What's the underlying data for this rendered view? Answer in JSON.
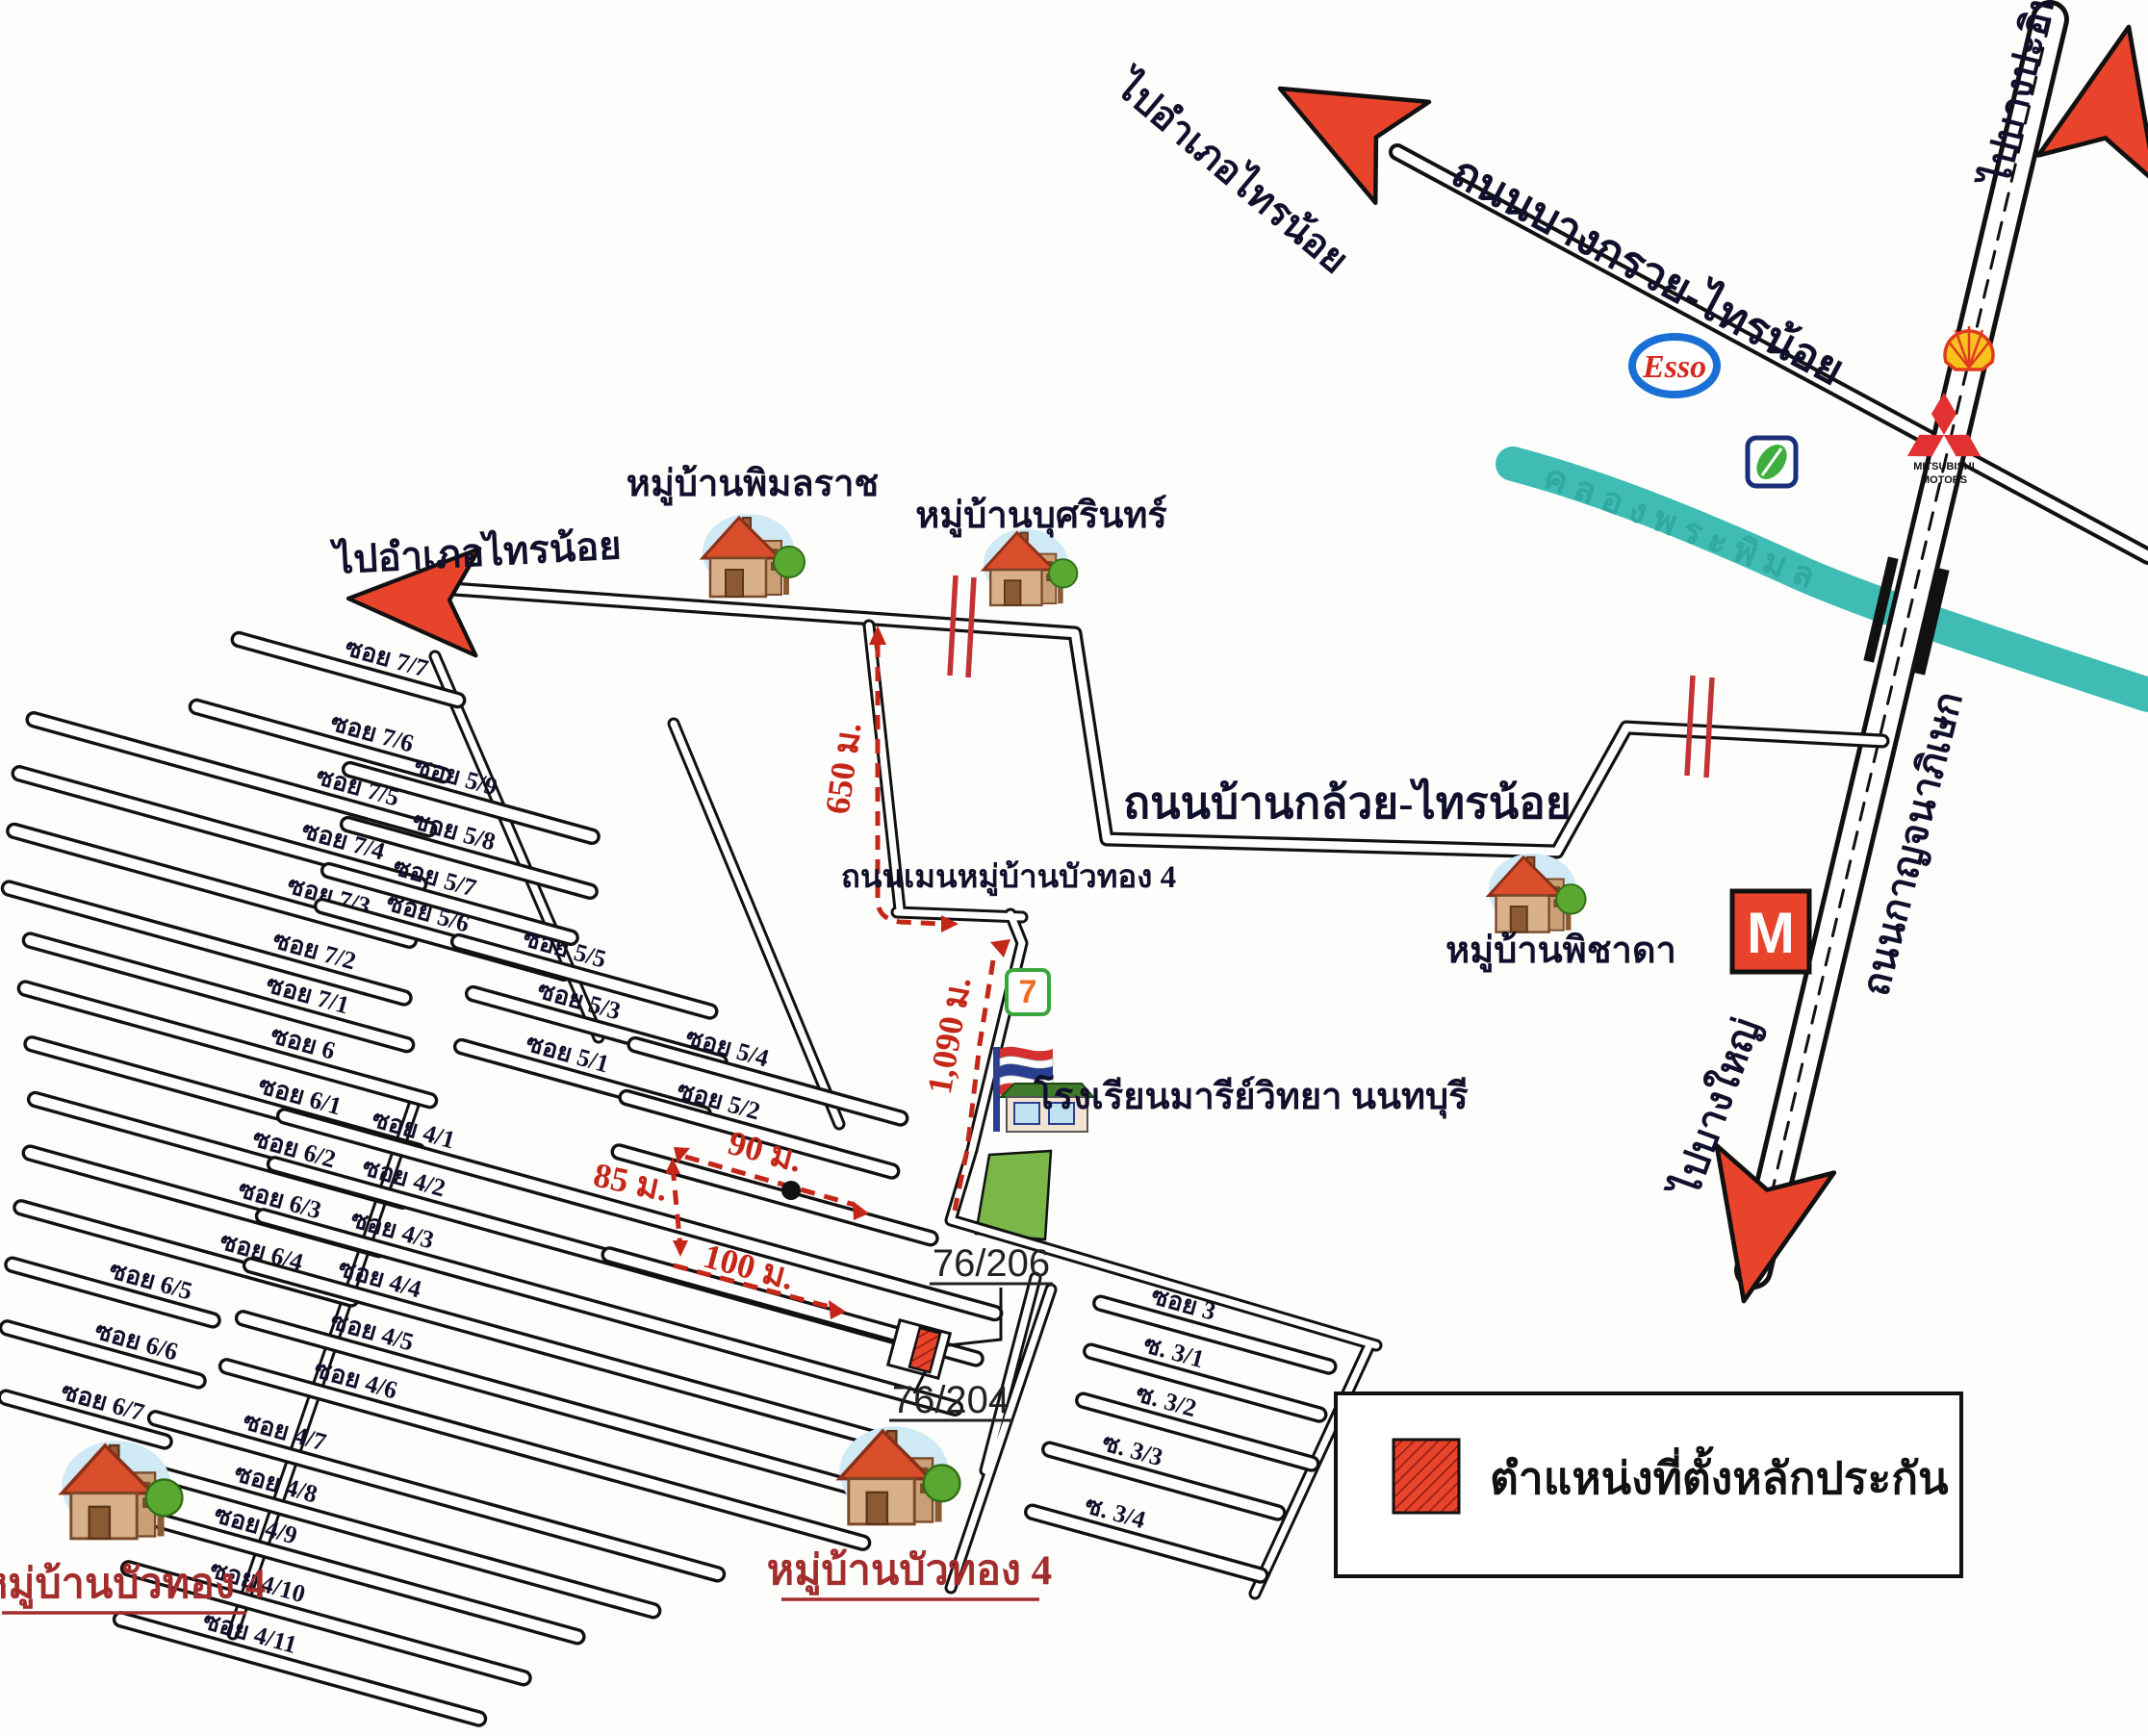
{
  "map": {
    "directions": {
      "to_sainoi_diag": "ไปอำเภอไทรน้อย",
      "to_bangpain": "ไปบางปะอิน",
      "to_sainoi_left": "ไปอำเภอไทรน้อย",
      "to_bangyai": "ไปบางใหญ่"
    },
    "roads": {
      "bangkruai_sainoi": "ถนนบางกรวย-ไทรน้อย",
      "kanchanaphisek": "ถนนกาญจนาภิเษก",
      "bankluai_sainoi": "ถนนบ้านกล้วย-ไทรน้อย",
      "main_buathong": "ถนนเมนหมู่บ้านบัวทอง 4"
    },
    "canal": "คลองพระพิมล",
    "places": {
      "pimonrat": "หมู่บ้านพิมลราช",
      "busarin": "หมู่บ้านบุศรินทร์",
      "phichada": "หมู่บ้านพิชาดา",
      "school": "โรงเรียนมารีย์วิทยา นนทบุรี",
      "buathong_left": "หมู่บ้านบัวทอง 4",
      "buathong_center": "หมู่บ้านบัวทอง 4"
    },
    "distances": {
      "d650": "650 ม.",
      "d1090": "1,090 ม.",
      "d90": "90 ม.",
      "d85": "85 ม.",
      "d100": "100 ม."
    },
    "house_numbers": {
      "upper": "76/206",
      "lower": "76/204"
    },
    "sois": {
      "colA": [
        "ซอย 7/7",
        "ซอย 7/6",
        "ซอย 7/5",
        "ซอย 7/4",
        "ซอย 7/3",
        "ซอย 7/2",
        "ซอย 7/1",
        "ซอย 6",
        "ซอย 6/1",
        "ซอย 6/2",
        "ซอย 6/3",
        "ซอย 6/4",
        "ซอย 6/5",
        "ซอย 6/6",
        "ซอย 6/7"
      ],
      "colB": [
        "ซอย 5/9",
        "ซอย 5/8",
        "ซอย 5/7",
        "ซอย 5/6",
        "ซอย 5/5",
        "ซอย 5/3",
        "ซอย 5/1",
        "ซอย 5/4",
        "ซอย 5/2"
      ],
      "colC": [
        "ซอย 4/1",
        "ซอย 4/2",
        "ซอย 4/3",
        "ซอย 4/4",
        "ซอย 4/5",
        "ซอย 4/6",
        "ซอย 4/7",
        "ซอย 4/8",
        "ซอย 4/9",
        "ซอย 4/10",
        "ซอย 4/11"
      ],
      "colD": [
        "ซอย 3",
        "ซ. 3/1",
        "ซ. 3/2",
        "ซ. 3/3",
        "ซ. 3/4"
      ]
    },
    "legend": {
      "label": "ตำแหน่งที่ตั้งหลักประกัน"
    },
    "logos": {
      "esso": "Esso",
      "seven": "7",
      "mitsubishi": "MITSUBISHI",
      "motors": "MOTORS",
      "makro_m": "M"
    },
    "colors": {
      "accent_red": "#e8432b",
      "route_red": "#c42618",
      "canal_teal": "#3fbdb5",
      "field_green": "#7ab648",
      "text_navy": "#10102c"
    }
  }
}
